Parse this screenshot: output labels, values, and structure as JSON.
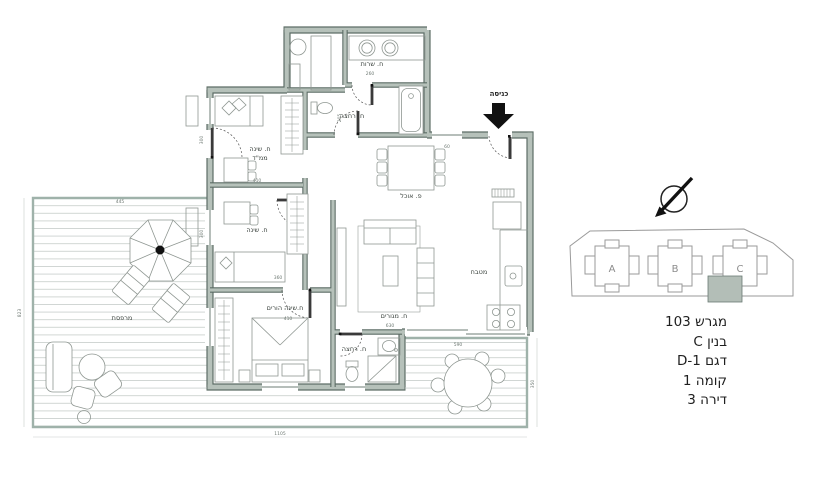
{
  "colors": {
    "wall-edge": "#5d6d66",
    "wall-fill": "#b6c1ba",
    "deck-line": "#c6cdc9",
    "terrace-border": "#9fb2aa",
    "furniture-line": "#8f9792",
    "label-color": "#3c443f",
    "dim-color": "#6f7a74",
    "arrow-color": "#111111",
    "site-line": "#9a9a9a",
    "highlight-fill": "#b3beb7",
    "text-color": "#1f1f1f"
  },
  "plan": {
    "entrance_label": "כניסה",
    "rooms": [
      {
        "name": "bedroom-mamad",
        "label": "ח. שינה",
        "label2": "ממ\"ד"
      },
      {
        "name": "bedroom-2",
        "label": "ח. שינה"
      },
      {
        "name": "master-bedroom",
        "label": "ח.שינה הורים"
      },
      {
        "name": "bathroom-top",
        "label": "ח. רחצה"
      },
      {
        "name": "service-room",
        "label": "ח. שרות"
      },
      {
        "name": "bathroom-master",
        "label": "ח. רחצה"
      },
      {
        "name": "living-room",
        "label": "ח. מגורים"
      },
      {
        "name": "kitchen",
        "label": "מטבח"
      },
      {
        "name": "dining-corner",
        "label": "פ. אוכל"
      },
      {
        "name": "terrace",
        "label": "מרפסת"
      }
    ],
    "dimensions": [
      "445",
      "300",
      "410",
      "300",
      "360",
      "410",
      "260",
      "205",
      "60",
      "630",
      "590",
      "350",
      "1105",
      "823"
    ]
  },
  "site_key": {
    "buildings": [
      {
        "letter": "A"
      },
      {
        "letter": "B"
      },
      {
        "letter": "C"
      }
    ],
    "info_lines": [
      "מגרש 103",
      "בנין C",
      "דגם D-1",
      "קומה 1",
      "דירה 3"
    ]
  }
}
